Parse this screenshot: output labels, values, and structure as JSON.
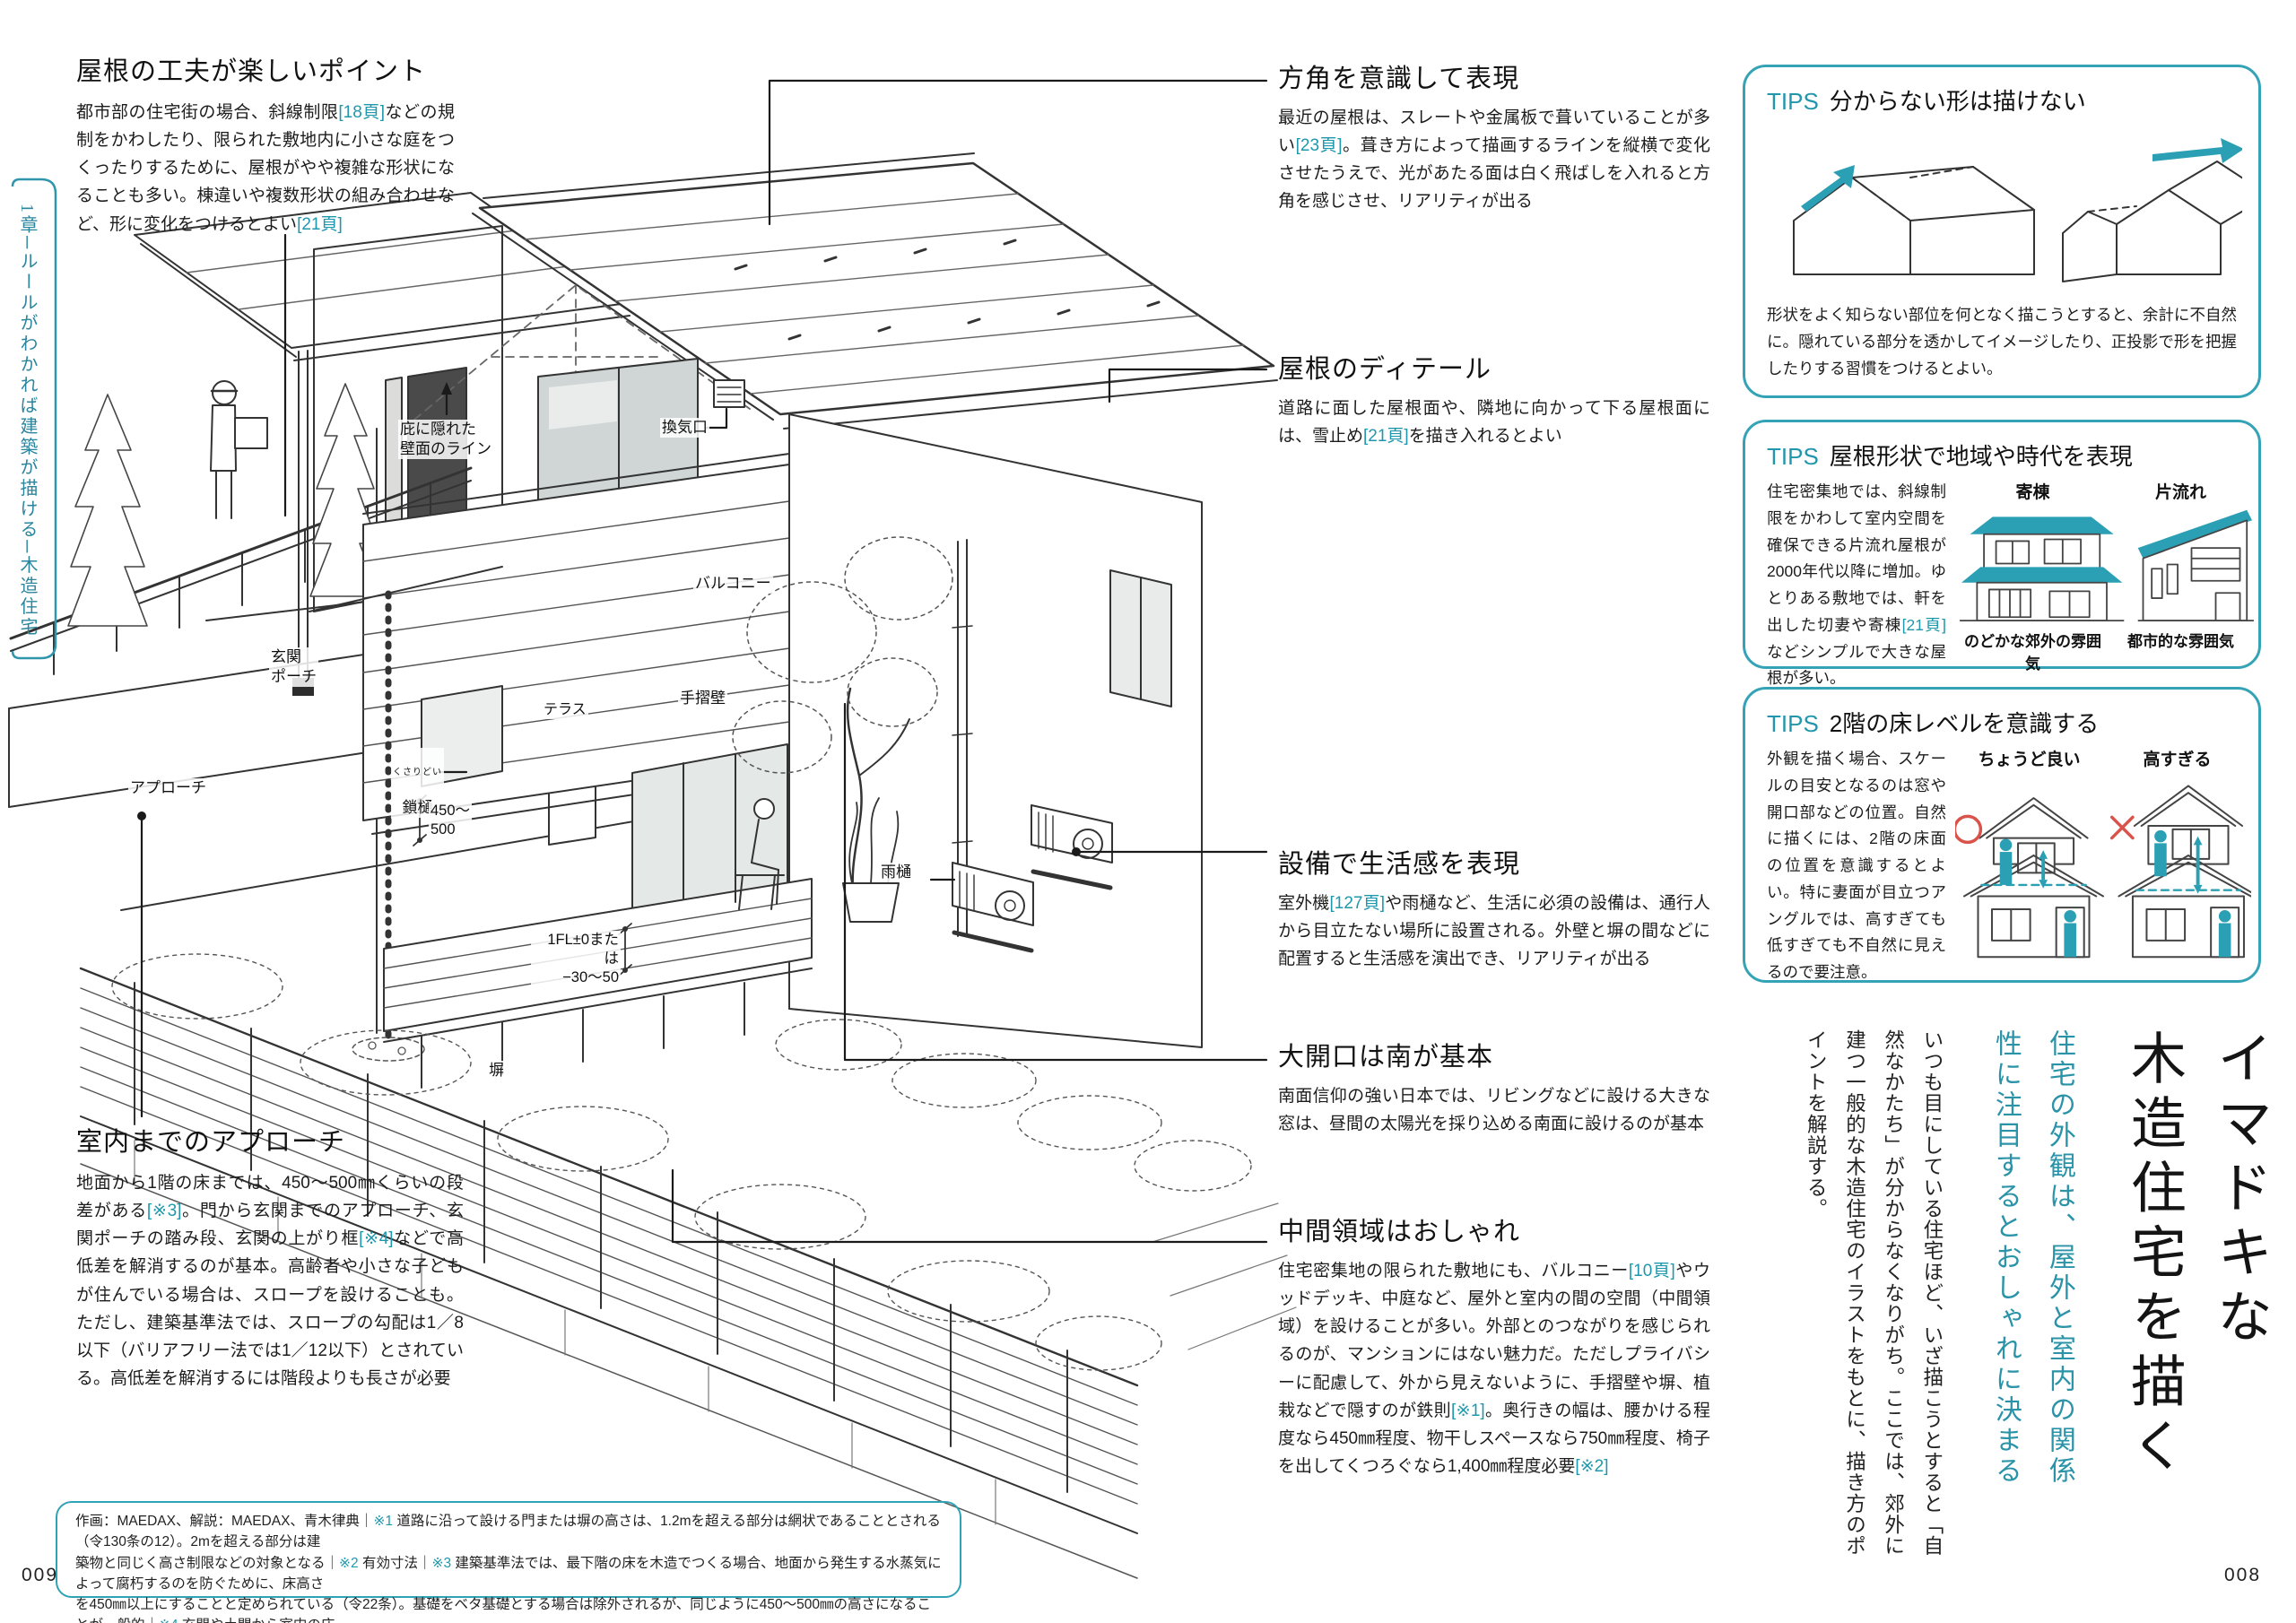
{
  "accent": "#2196ad",
  "page_numbers": {
    "left": "009",
    "right": "008"
  },
  "chapter_tab": {
    "text": "1章─ルールがわかれば建築が描ける─木造住宅"
  },
  "annotations": {
    "roof_point": {
      "heading": "屋根の工夫が楽しいポイント",
      "body": [
        {
          "t": "都市部の住宅街の場合、斜線制限"
        },
        {
          "t": "[18頁]",
          "ref": true
        },
        {
          "t": "などの規制をかわしたり、限られた敷地内に小さな庭をつくったりするために、屋根がやや複雑な形状になることも多い。棟違いや複数形状の組み合わせなど、形に変化をつけるとよい"
        },
        {
          "t": "[21頁]",
          "ref": true
        }
      ]
    },
    "direction": {
      "heading": "方角を意識して表現",
      "body": [
        {
          "t": "最近の屋根は、スレートや金属板で葺いていることが多い"
        },
        {
          "t": "[23頁]",
          "ref": true
        },
        {
          "t": "。葺き方によって描画するラインを縦横で変化させたうえで、光があたる面は白く飛ばしを入れると方角を感じさせ、リアリティが出る"
        }
      ]
    },
    "roof_detail": {
      "heading": "屋根のディテール",
      "body": [
        {
          "t": "道路に面した屋根面や、隣地に向かって下る屋根面には、雪止め"
        },
        {
          "t": "[21頁]",
          "ref": true
        },
        {
          "t": "を描き入れるとよい"
        }
      ]
    },
    "equipment": {
      "heading": "設備で生活感を表現",
      "body": [
        {
          "t": "室外機"
        },
        {
          "t": "[127頁]",
          "ref": true
        },
        {
          "t": "や雨樋など、生活に必須の設備は、通行人から目立たない場所に設置される。外壁と塀の間などに配置すると生活感を演出でき、リアリティが出る"
        }
      ]
    },
    "opening": {
      "heading": "大開口は南が基本",
      "body": [
        {
          "t": "南面信仰の強い日本では、リビングなどに設ける大きな窓は、昼間の太陽光を採り込める南面に設けるのが基本"
        }
      ]
    },
    "intermediate": {
      "heading": "中間領域はおしゃれ",
      "body": [
        {
          "t": "住宅密集地の限られた敷地にも、バルコニー"
        },
        {
          "t": "[10頁]",
          "ref": true
        },
        {
          "t": "やウッドデッキ、中庭など、屋外と室内の間の空間（中間領域）を設けることが多い。外部とのつながりを感じられるのが、マンションにはない魅力だ。ただしプライバシーに配慮して、外から見えないように、手摺壁や塀、植栽などで隠すのが鉄則"
        },
        {
          "t": "[※1]",
          "ref": true
        },
        {
          "t": "。奥行きの幅は、腰かける程度なら450㎜程度、物干しスペースなら750㎜程度、椅子を出してくつろぐなら1,400㎜程度必要"
        },
        {
          "t": "[※2]",
          "ref": true
        }
      ]
    },
    "approach": {
      "heading": "室内までのアプローチ",
      "body": [
        {
          "t": "地面から1階の床までは、450〜500㎜くらいの段差がある"
        },
        {
          "t": "[※3]",
          "ref": true
        },
        {
          "t": "。門から玄関までのアプローチ、玄関ポーチの踏み段、玄関の上がり框"
        },
        {
          "t": "[※4]",
          "ref": true
        },
        {
          "t": "などで高低差を解消するのが基本。高齢者や小さな子どもが住んでいる場合は、スロープを設けることも。ただし、建築基準法では、スロープの勾配は1／8以下（バリアフリー法では1／12以下）とされている。高低差を解消するには階段よりも長さが必要"
        }
      ]
    }
  },
  "tips": [
    {
      "label": "TIPS",
      "title": "分からない形は描けない",
      "body": "形状をよく知らない部位を何となく描こうとすると、余計に不自然に。隠れている部分を透かしてイメージしたり、正投影で形を把握したりする習慣をつけるとよい。"
    },
    {
      "label": "TIPS",
      "title": "屋根形状で地域や時代を表現",
      "body": [
        {
          "t": "住宅密集地では、斜線制限をかわして室内空間を確保できる片流れ屋根が2000年代以降に増加。ゆとりある敷地では、軒を出した切妻や寄棟"
        },
        {
          "t": "[21頁]",
          "ref": true
        },
        {
          "t": "などシンプルで大きな屋根が多い。"
        }
      ],
      "diagrams": [
        {
          "label": "寄棟",
          "caption": "のどかな郊外の雰囲気"
        },
        {
          "label": "片流れ",
          "caption": "都市的な雰囲気"
        }
      ]
    },
    {
      "label": "TIPS",
      "title": "2階の床レベルを意識する",
      "body": "外観を描く場合、スケールの目安となるのは窓や開口部などの位置。自然に描くには、2階の床面の位置を意識するとよい。特に妻面が目立つアングルでは、高すぎても低すぎても不自然に見えるので要注意。",
      "diagrams": [
        {
          "label": "ちょうど良い"
        },
        {
          "label": "高すぎる"
        }
      ]
    }
  ],
  "title_block": {
    "title": "イマドキな\n木造住宅を描く",
    "subtitle": "住宅の外観は、屋外と室内の関係\n性に注目するとおしゃれに決まる",
    "body": "いつも目にしている住宅ほど、いざ描こうとすると「自\n然なかたち」が分からなくなりがち。ここでは、郊外に\n建つ一般的な木造住宅のイラストをもとに、描き方のポ\nイントを解説する。"
  },
  "illustration": {
    "labels": {
      "hidden_wall": "庇に隠れた\n壁面のライン",
      "vent": "換気口",
      "balcony": "バルコニー",
      "rail_wall": "手摺壁",
      "terrace": "テラス",
      "chain_furigana": "くさりどい",
      "chain": "鎖樋",
      "dim_450": "450〜\n500",
      "fl": "1FL±0または\n−30〜50",
      "fence": "塀",
      "rain_gutter": "雨樋",
      "porch": "玄関\nポーチ",
      "approach": "アプローチ"
    }
  },
  "footnote": {
    "lines": [
      [
        {
          "t": "作画：MAEDAX、解説：MAEDAX、青木律典｜"
        },
        {
          "t": "※1",
          "ref": true
        },
        {
          "t": " 道路に沿って設ける門または塀の高さは、1.2mを超える部分は網状であることとされる（令130条の12）。2mを超える部分は建"
        }
      ],
      [
        {
          "t": "築物と同じく高さ制限などの対象となる｜"
        },
        {
          "t": "※2",
          "ref": true
        },
        {
          "t": " 有効寸法｜"
        },
        {
          "t": "※3",
          "ref": true
        },
        {
          "t": " 建築基準法では、最下階の床を木造でつくる場合、地面から発生する水蒸気によって腐朽するのを防ぐために、床高さ"
        }
      ],
      [
        {
          "t": "を450㎜以上にすることと定められている（令22条）。基礎をベタ基礎とする場合は除外されるが、同じように450〜500㎜の高さになることが一般的｜"
        },
        {
          "t": "※4",
          "ref": true
        },
        {
          "t": " 玄関や土間から室内の床"
        }
      ],
      [
        {
          "t": "に上がる段差に設けられる横木のこと"
        }
      ]
    ]
  }
}
